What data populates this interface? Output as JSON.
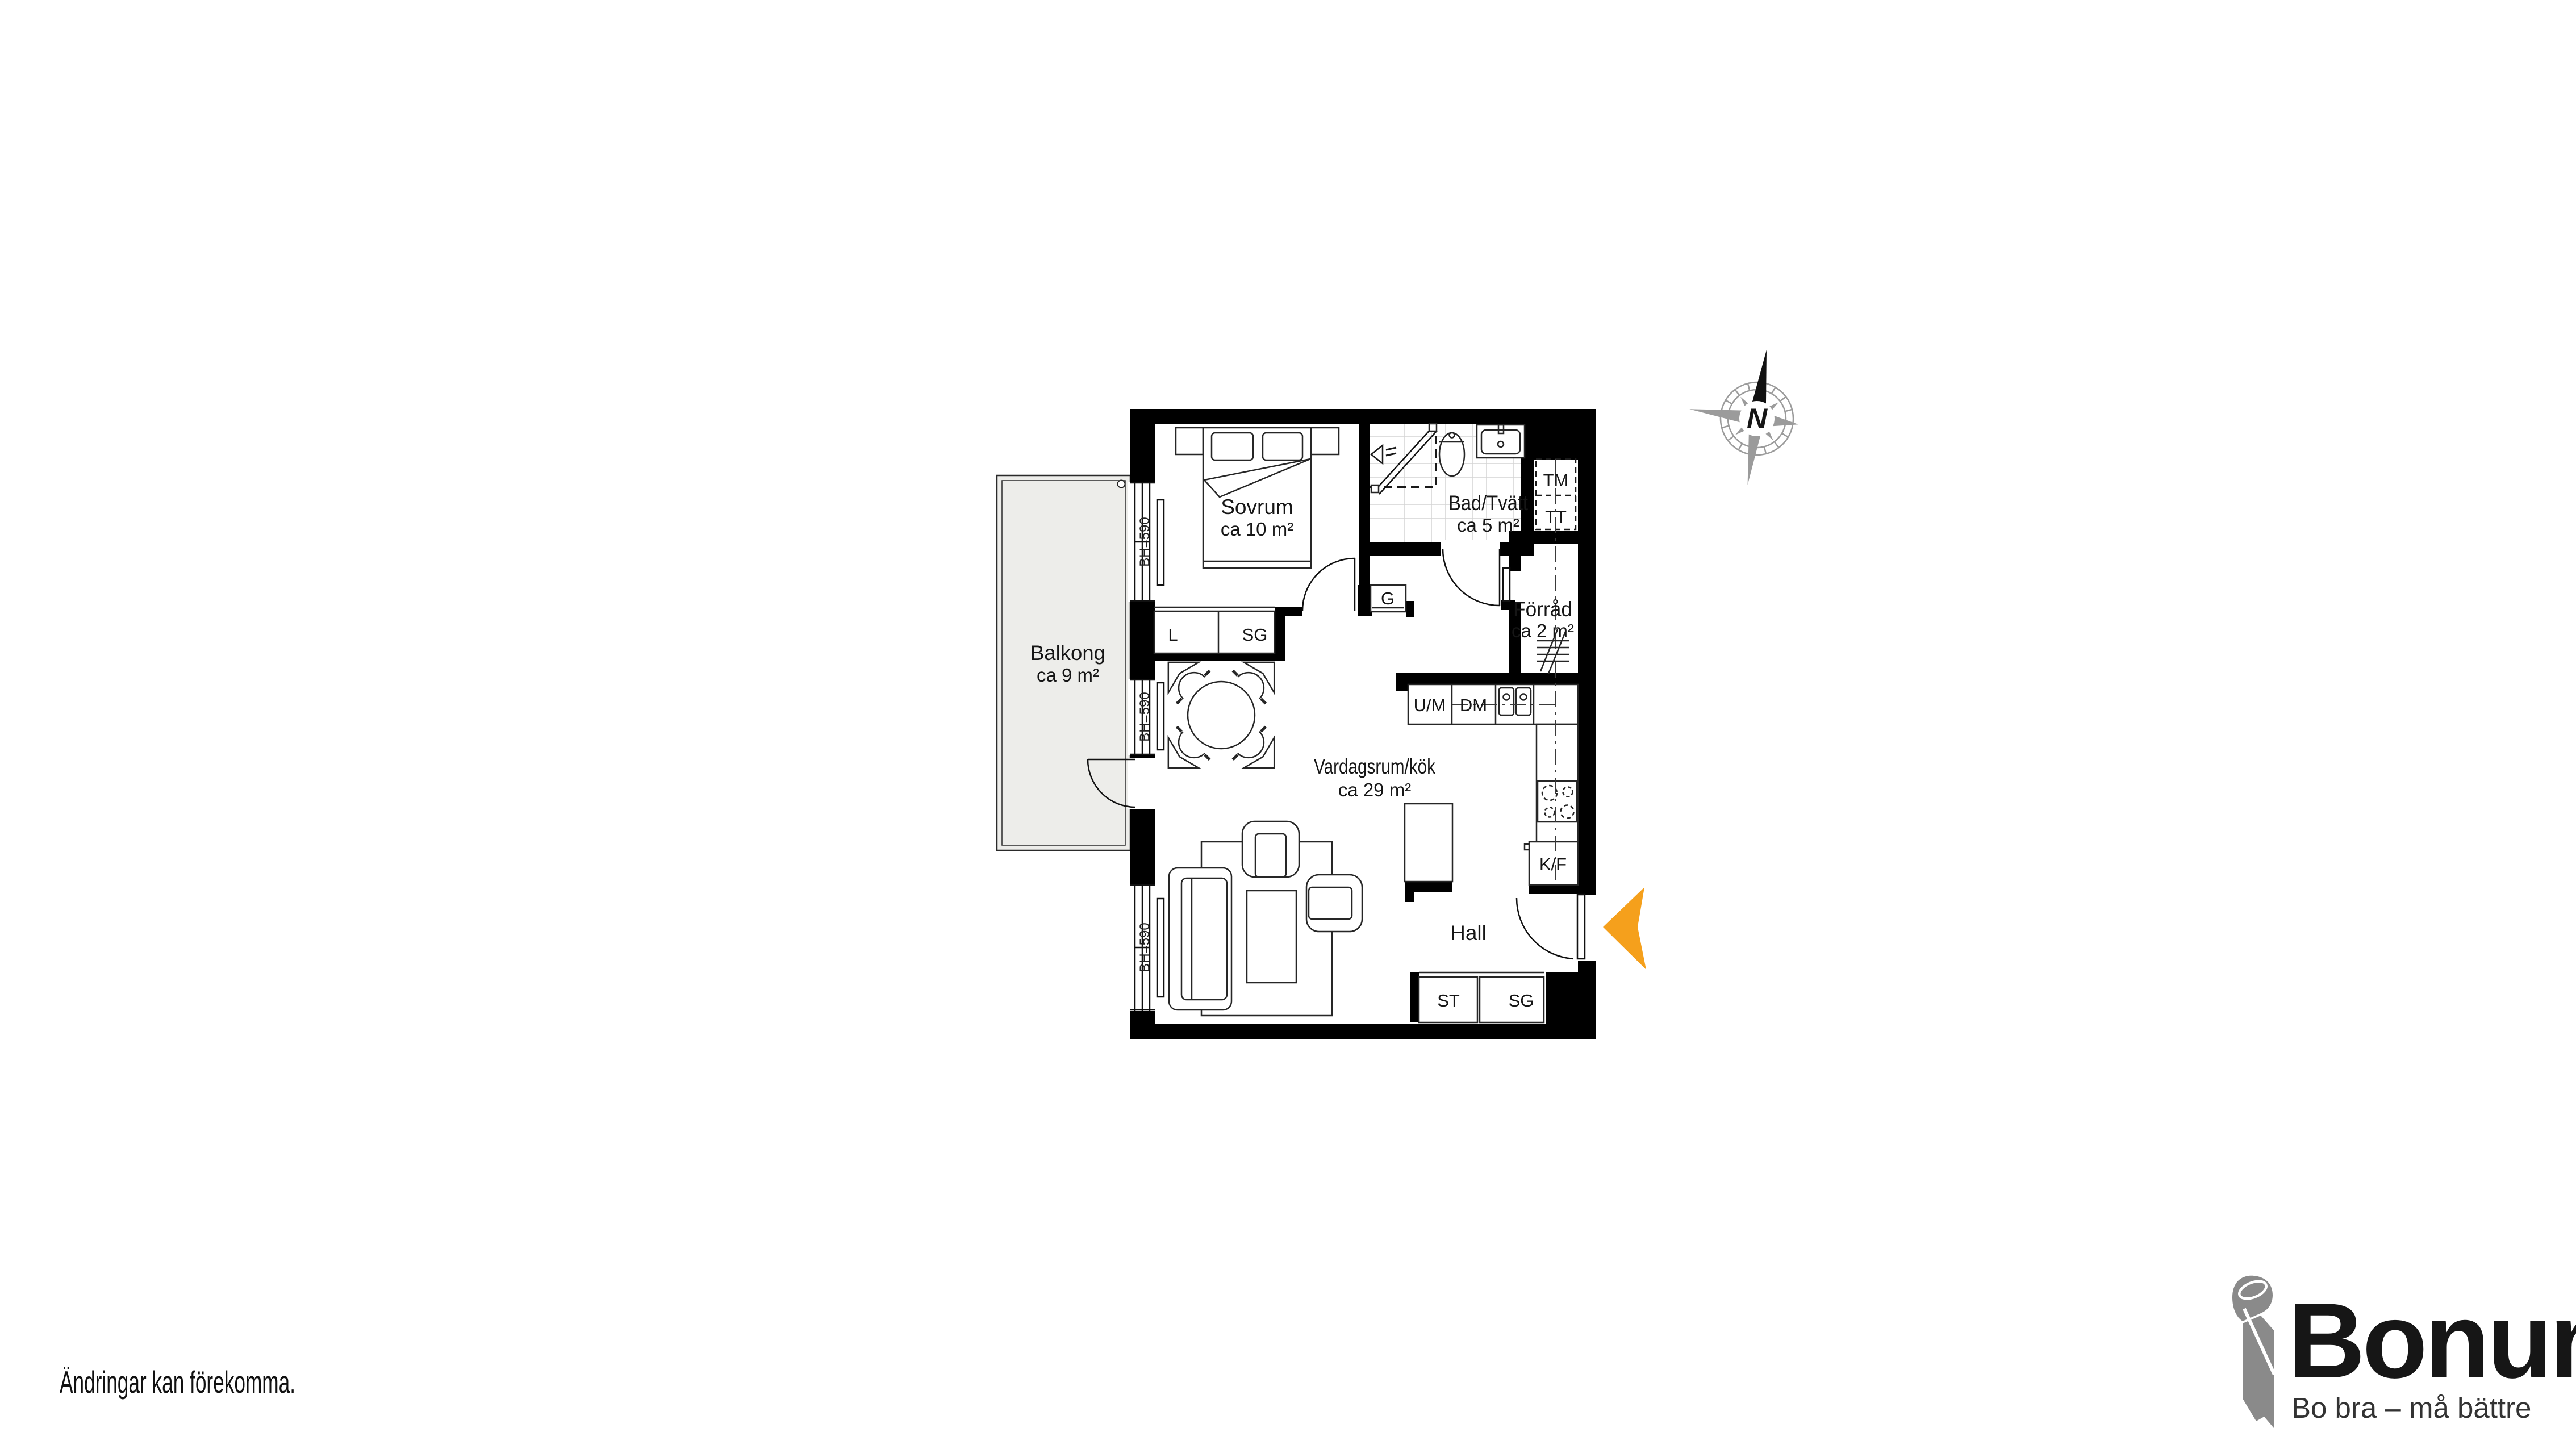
{
  "page": {
    "background": "#ffffff",
    "disclaimer": "Ändringar kan förekomma."
  },
  "floorplan": {
    "rooms": {
      "sovrum": {
        "name": "Sovrum",
        "area": "ca 10 m²"
      },
      "bad": {
        "name": "Bad/Tvätt",
        "area": "ca 5 m²"
      },
      "balkong": {
        "name": "Balkong",
        "area": "ca 9 m²"
      },
      "vardagsrum": {
        "name": "Vardagsrum/kök",
        "area": "ca 29 m²"
      },
      "forrad": {
        "name": "Förråd",
        "area": "ca 2 m²"
      },
      "hall": {
        "name": "Hall"
      }
    },
    "labels": {
      "tm": "TM",
      "tt": "TT",
      "g": "G",
      "l": "L",
      "sg_bedroom": "SG",
      "um": "U/M",
      "dm": "DM",
      "kf": "K/F",
      "st": "ST",
      "sg_hall": "SG",
      "window_height": "BH=590"
    },
    "compass": {
      "north": "N"
    },
    "colors": {
      "wall": "#000000",
      "balcony_fill": "#EDEDEA",
      "entry_arrow": "#F5A01C",
      "compass_gray": "#9B9B9B"
    }
  },
  "logo": {
    "brand": "Bonum",
    "tagline": "Bo bra – må bättre",
    "brand_color": "#F39200",
    "icon_gray": "#8A8A8A"
  }
}
